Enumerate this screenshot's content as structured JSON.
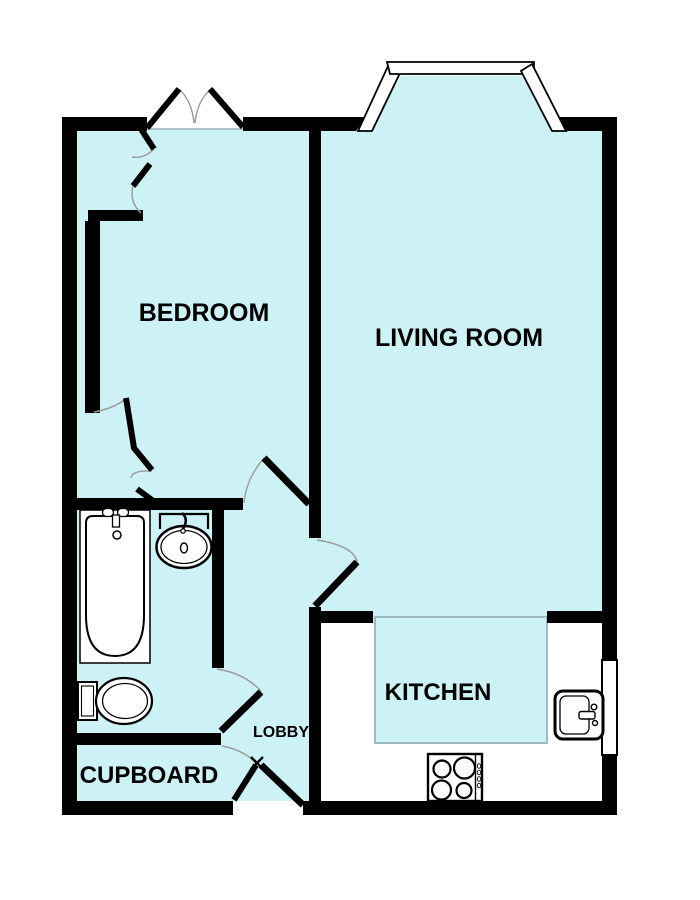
{
  "title": "One-bedroom flat floor plan",
  "colors": {
    "floor": "#cdf2f5",
    "wall": "#000000",
    "window": "#ffffff",
    "fixture_fill": "#ffffff",
    "door_arc": "#9a9a9a",
    "island_border": "#9fb9bd",
    "text": "#000000"
  },
  "rooms": [
    {
      "label": "BEDROOM"
    },
    {
      "label": "LIVING ROOM"
    },
    {
      "label": "KITCHEN"
    },
    {
      "label": "LOBBY"
    },
    {
      "label": "CUPBOARD"
    }
  ],
  "fixtures": {
    "bathroom": [
      "bath",
      "wash-basin",
      "toilet"
    ],
    "kitchen": [
      "sink",
      "hob",
      "worktop"
    ]
  },
  "windows": [
    "bay-window",
    "bedroom-window",
    "kitchen-window"
  ],
  "doors": [
    "entrance-door",
    "bedroom-door",
    "living-room-door",
    "bathroom-door",
    "cupboard-door",
    "wardrobe-doors"
  ]
}
